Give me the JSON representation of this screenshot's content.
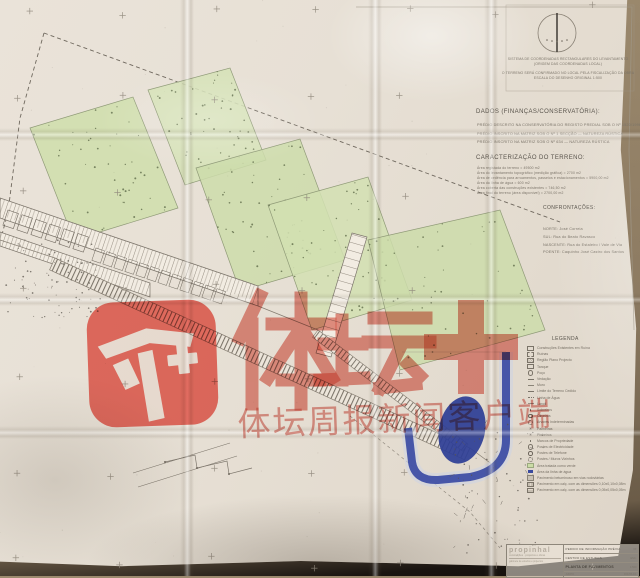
{
  "watermark": {
    "brand": "体坛+",
    "subtitle": "体坛周报新闻客户端",
    "icon": "titan-sports-plus-logo",
    "color": "#e2483c"
  },
  "drawing": {
    "compass": "north-needle-compass",
    "coord_notes": [
      "SISTEMA DE COORDENADAS RECTANGULARES DO LEVANTAMENTO",
      "(ORIGEM DAS COORDENADAS LOCAL)",
      "O TERRENO SERÁ CONFIRMADO NO LOCAL PELA FISCALIZAÇÃO DA OBRA",
      "ESCALA DO DESENHO ORIGINAL 1:500"
    ],
    "dados": {
      "title": "DADOS (FINANÇAS/CONSERVATÓRIA):",
      "lines": [
        "PRÉDIO DESCRITO NA CONSERVATÓRIA DO REGISTO PREDIAL SOB O Nº 1520/19960613 DA FREGUESIA",
        "PRÉDIO INSCRITO NA MATRIZ SOB O Nº 1 SECÇÃO — NATUREZA RÚSTICA",
        "PRÉDIO INSCRITO NA MATRIZ SOB O Nº 634 — NATUREZA RÚSTICA"
      ]
    },
    "caracterizacao": {
      "title": "CARACTERIZAÇÃO DO TERRENO:",
      "lines": [
        "Área registada do terreno = 49500 m2",
        "Área do levantamento topográfico (medição gráfica) = 2700 m2",
        "Área de cedência para arruamentos, passeios e estacionamentos = 5900,00 m2",
        "Área da linha de água = 600 m2",
        "Área coberta das construções existentes = 746,50 m2",
        "Área final do terreno (área disponível) = 2700,00 m2"
      ]
    },
    "confrontacoes": {
      "title": "CONFRONTAÇÕES:",
      "lines": [
        "NORTE: José Correia",
        "SUL: Rua do Beato Ravasco",
        "NASCENTE: Rua do Estaleiro / Vale de Via",
        "POENTE: Caquinho José Castro dos Santos"
      ]
    },
    "legenda": {
      "title": "LEGENDA",
      "items": [
        {
          "sym": "s-box",
          "label": "Construções Existentes em Ruína"
        },
        {
          "sym": "s-dash",
          "label": "Ruínas"
        },
        {
          "sym": "s-hatch",
          "label": "Região Plano Projecto"
        },
        {
          "sym": "s-rect",
          "label": "Tanque"
        },
        {
          "sym": "s-circ",
          "label": "Poço"
        },
        {
          "sym": "s-line",
          "label": "Vedação"
        },
        {
          "sym": "s-line2",
          "label": "Muro"
        },
        {
          "sym": "s-dashln",
          "label": "Limite do Terreno Cedido"
        },
        {
          "sym": "s-dashdot",
          "label": "Linha de Água"
        },
        {
          "sym": "s-thin",
          "label": "Lancil"
        },
        {
          "sym": "s-dot",
          "label": "Sobreiros"
        },
        {
          "sym": "s-ring",
          "label": "Oliveiras"
        },
        {
          "sym": "s-ring2",
          "label": "Árvores Indeterminadas"
        },
        {
          "sym": "s-star",
          "label": "Palmeiras"
        },
        {
          "sym": "s-star",
          "label": "Pinheiros"
        },
        {
          "sym": "s-dot",
          "label": "Marcos de Propriedade"
        },
        {
          "sym": "s-circ",
          "label": "Postes de Electricidade"
        },
        {
          "sym": "s-ring",
          "label": "Postes de Telefone"
        },
        {
          "sym": "s-ring2",
          "label": "Postes / Muros Vizinhos"
        },
        {
          "sym": "s-green",
          "label": "Área tratada como verde"
        },
        {
          "sym": "s-blue",
          "label": "Área da linha de água"
        },
        {
          "sym": "s-grey",
          "label": "Pavimento betuminoso em vias rodoviárias"
        },
        {
          "sym": "s-pav",
          "label": "Pavimento em calç. com as dimensões 0,10x0,10x0,08m"
        },
        {
          "sym": "s-pav2",
          "label": "Pavimento em calç. com as dimensões 0,05x0,05x0,05m"
        }
      ]
    },
    "title_block": {
      "logo": "propinhal",
      "logo_tagline": "construções · projectos e obras",
      "logo_sub": "gabinete de estudos e projectos",
      "rows": [
        {
          "label": "PEDIDO DE INFORMAÇÃO PRÉVIA",
          "tag": "Nº"
        },
        {
          "label": "CENTRO DE ESTUDOS",
          "tag": "ESC."
        },
        {
          "label": "PLANTA DE PAVIMENTOS",
          "tag": "1:500"
        }
      ],
      "meta_left": "JUNHO",
      "meta_right": "FOLHA 1/1"
    }
  },
  "colors": {
    "paper": "#e8e1d7",
    "parcel_green": "#cddcaa",
    "water_blue": "#34439b",
    "watermark_red": "#e2483c",
    "ink": "#6b645a"
  }
}
